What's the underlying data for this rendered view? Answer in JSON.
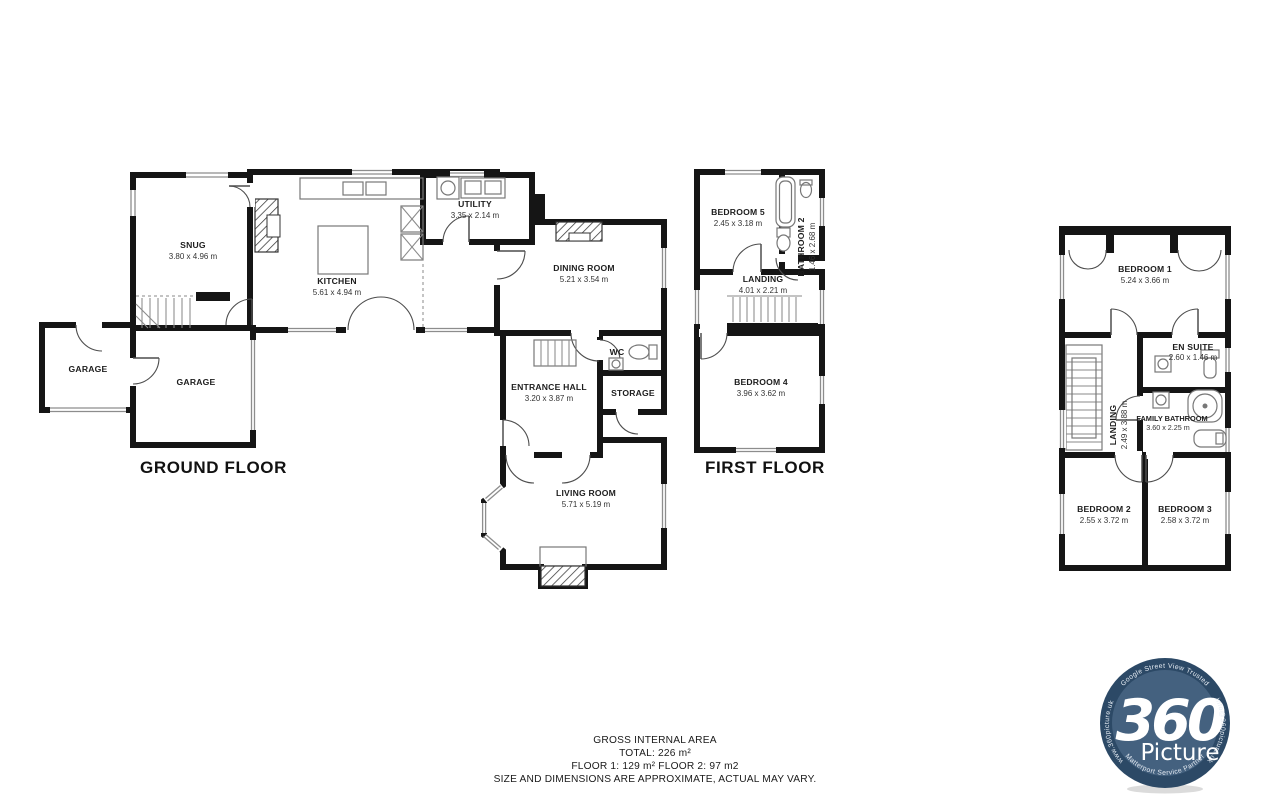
{
  "colors": {
    "wall": "#151515",
    "logo_badge": "#44617f",
    "logo_ring": "#2c4966",
    "text": "#1d1d1d"
  },
  "floors": {
    "ground": {
      "label": "GROUND FLOOR",
      "rooms": {
        "snug": {
          "name": "SNUG",
          "dims": "3.80 x 4.96 m"
        },
        "kitchen": {
          "name": "KITCHEN",
          "dims": "5.61 x 4.94 m"
        },
        "utility": {
          "name": "UTILITY",
          "dims": "3.35 x 2.14 m"
        },
        "dining": {
          "name": "DINING ROOM",
          "dims": "5.21 x 3.54 m"
        },
        "entrance": {
          "name": "ENTRANCE HALL",
          "dims": "3.20 x 3.87 m"
        },
        "wc": {
          "name": "WC"
        },
        "storage": {
          "name": "STORAGE"
        },
        "living": {
          "name": "LIVING ROOM",
          "dims": "5.71 x 5.19 m"
        },
        "garage_left": {
          "name": "GARAGE"
        },
        "garage_right": {
          "name": "GARAGE"
        }
      }
    },
    "first": {
      "label": "FIRST FLOOR",
      "rooms": {
        "bedroom5": {
          "name": "BEDROOM 5",
          "dims": "2.45 x 3.18 m"
        },
        "bathroom2": {
          "name": "BATHROOM 2",
          "dims": "1.46 x 2.68 m"
        },
        "landing": {
          "name": "LANDING",
          "dims": "4.01 x 2.21 m"
        },
        "bedroom4": {
          "name": "BEDROOM 4",
          "dims": "3.96 x 3.62 m"
        }
      }
    },
    "second": {
      "rooms": {
        "bedroom1": {
          "name": "BEDROOM 1",
          "dims": "5.24 x 3.66 m"
        },
        "ensuite": {
          "name": "EN SUITE",
          "dims": "2.60 x 1.46 m"
        },
        "landing": {
          "name": "LANDING",
          "dims": "2.49 x 3.88 m"
        },
        "family_bathroom": {
          "name": "FAMILY BATHROOM",
          "dims": "3.60 x 2.25 m"
        },
        "bedroom2": {
          "name": "BEDROOM 2",
          "dims": "2.55 x 3.72 m"
        },
        "bedroom3": {
          "name": "BEDROOM 3",
          "dims": "2.58 x 3.72 m"
        }
      }
    }
  },
  "footer": {
    "title": "GROSS INTERNAL AREA",
    "total": "TOTAL: 226 m²",
    "floors": "FLOOR 1: 129 m²  FLOOR 2: 97 m2",
    "disclaimer": "SIZE AND DIMENSIONS ARE APPROXIMATE, ACTUAL MAY VARY."
  },
  "logo": {
    "number": "360",
    "word": "Picture",
    "rim_top": "Google Street View Trusted",
    "rim_left": "www.360picture.uk",
    "rim_right": "info@360picture.uk",
    "rim_bottom": "Matterport Service Partner"
  }
}
